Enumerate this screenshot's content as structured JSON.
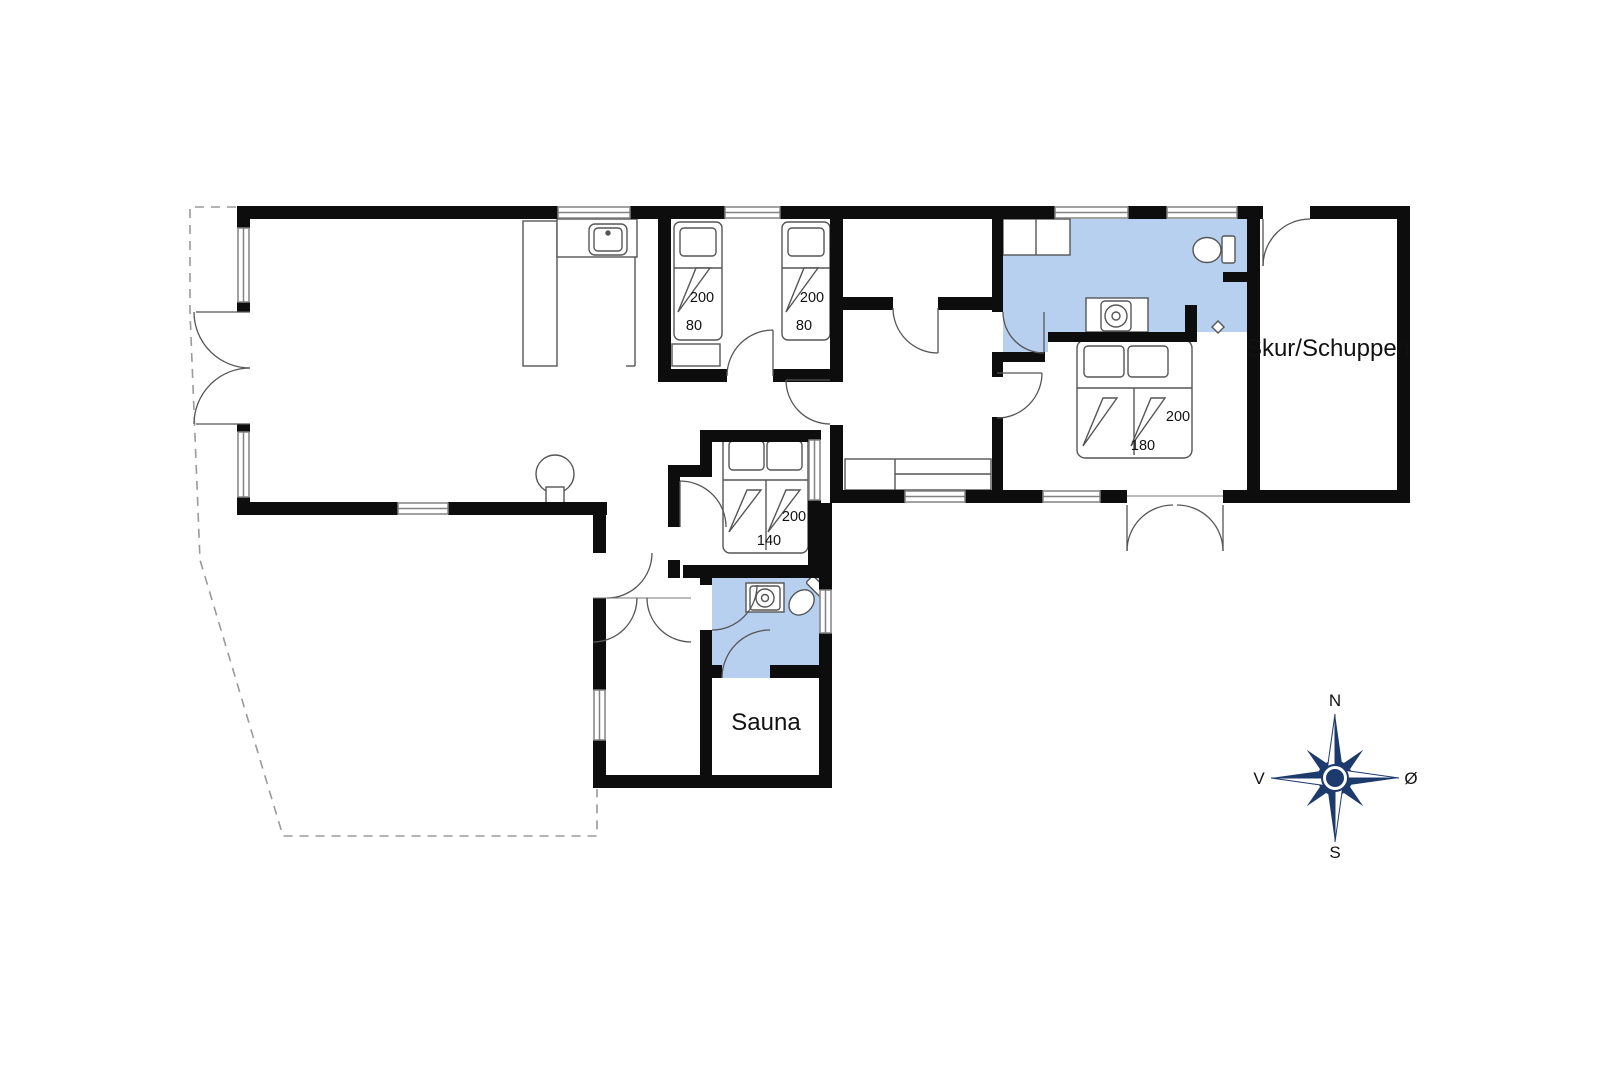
{
  "plan": {
    "rooms": {
      "shed_label": "Skur/Schuppen",
      "sauna_label": "Sauna"
    },
    "beds": {
      "single_left": {
        "length": "200",
        "width": "80"
      },
      "single_right": {
        "length": "200",
        "width": "80"
      },
      "double_middle": {
        "length": "200",
        "width": "140"
      },
      "double_right": {
        "length": "200",
        "width": "180"
      }
    },
    "compass": {
      "north": "N",
      "south": "S",
      "west": "V",
      "east": "Ø"
    },
    "colors": {
      "wall": "#0d0d0d",
      "furniture_line": "#555555",
      "wet_room_fill": "#b8d0f0",
      "window_stroke": "#828282",
      "terrace_dash": "#9a9a9a",
      "compass_navy": "#1d3a6d"
    }
  }
}
